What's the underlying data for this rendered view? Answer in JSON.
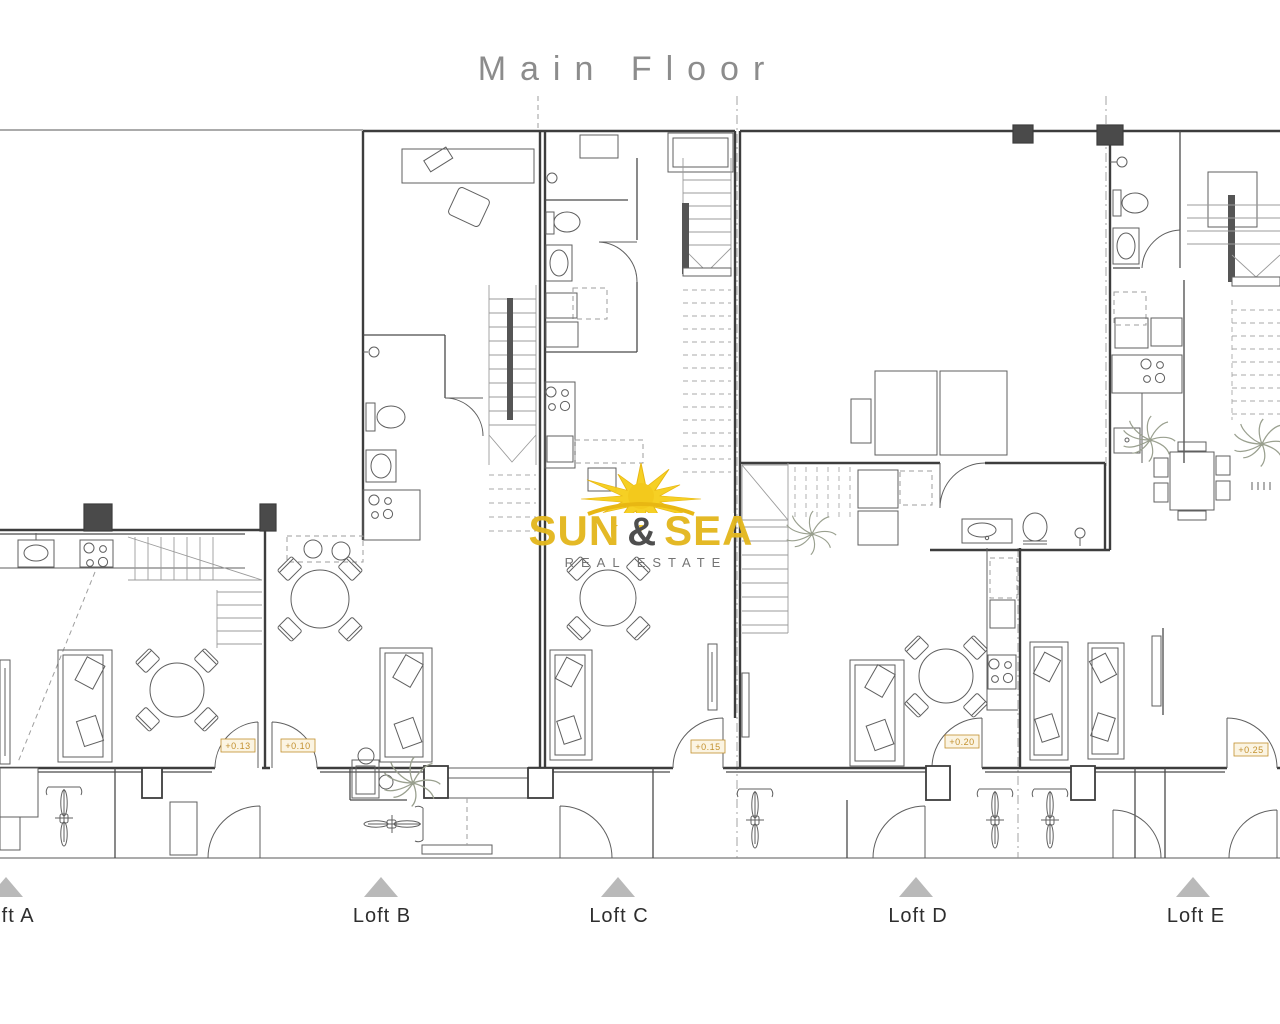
{
  "title": "Main Floor",
  "logo": {
    "word1": "SUN",
    "amp": "&",
    "word2": "SEA",
    "subtitle": "REAL ESTATE"
  },
  "lofts": [
    {
      "label": "Loft A",
      "elevation": "+0.13"
    },
    {
      "label": "Loft B",
      "elevation": "+0.10"
    },
    {
      "label": "Loft C",
      "elevation": "+0.15"
    },
    {
      "label": "Loft D",
      "elevation": "+0.20"
    },
    {
      "label": "Loft E",
      "elevation": "+0.25"
    }
  ],
  "colors": {
    "wall": "#3d3d3d",
    "furniture": "#5f5f5f",
    "stairs": "#9b9b9b",
    "title_text": "#8c8c8c",
    "loft_label_text": "#2e2e2e",
    "triangle_marker": "#b9b9b9",
    "elevation_text": "#c2902e",
    "elevation_bg": "#fbf4e2",
    "logo_gold": "#e3b71e",
    "logo_amp": "#474747",
    "logo_subtitle": "#6f6f6f",
    "sun_yellow": "#f6cf1c"
  }
}
